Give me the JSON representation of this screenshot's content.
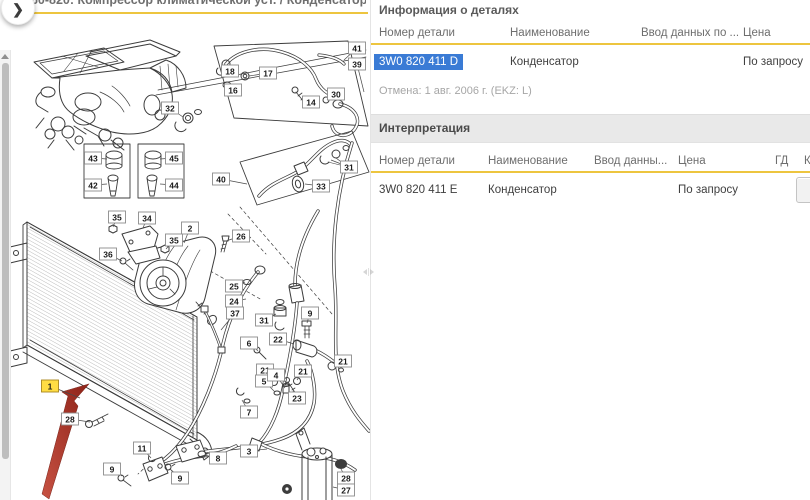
{
  "colors": {
    "accent_yellow": "#edc53f",
    "selection_blue": "#3a7bd5",
    "band_gray": "#e9e9e9",
    "highlight_yellow": "#ffdd44",
    "arrow_red": "#b13a2c"
  },
  "left_panel": {
    "title": "260-820: Компрессор климатической уст. / Конденсатор климат.уст...",
    "collapse_button": "❯",
    "diagram": {
      "highlighted_callout": "1",
      "callouts": [
        {
          "n": "32",
          "x": 170,
          "y": 108,
          "lx": 183,
          "ly": 117
        },
        {
          "n": "43",
          "x": 93,
          "y": 158,
          "lx": 107,
          "ly": 159
        },
        {
          "n": "42",
          "x": 93,
          "y": 185,
          "lx": 107,
          "ly": 184
        },
        {
          "n": "45",
          "x": 174,
          "y": 158,
          "lx": 160,
          "ly": 159
        },
        {
          "n": "44",
          "x": 174,
          "y": 185,
          "lx": 160,
          "ly": 184
        },
        {
          "n": "41",
          "x": 357,
          "y": 48,
          "lx": 344,
          "ly": 60
        },
        {
          "n": "39",
          "x": 357,
          "y": 64,
          "lx": 364,
          "ly": 92
        },
        {
          "n": "18",
          "x": 230,
          "y": 71,
          "lx": 222,
          "ly": 70
        },
        {
          "n": "16",
          "x": 233,
          "y": 90,
          "lx": 227,
          "ly": 84
        },
        {
          "n": "17",
          "x": 268,
          "y": 73,
          "lx": 249,
          "ly": 76
        },
        {
          "n": "14",
          "x": 311,
          "y": 102,
          "lx": 303,
          "ly": 99
        },
        {
          "n": "30",
          "x": 336,
          "y": 94,
          "lx": 327,
          "ly": 100
        },
        {
          "n": "31",
          "x": 349,
          "y": 167,
          "lx": 331,
          "ly": 160
        },
        {
          "n": "40",
          "x": 221,
          "y": 179,
          "lx": 247,
          "ly": 184
        },
        {
          "n": "33",
          "x": 321,
          "y": 186,
          "lx": 305,
          "ly": 184
        },
        {
          "n": "26",
          "x": 241,
          "y": 236,
          "lx": 226,
          "ly": 241
        },
        {
          "n": "2",
          "x": 190,
          "y": 228,
          "lx": 184,
          "ly": 243
        },
        {
          "n": "34",
          "x": 147,
          "y": 218,
          "lx": 143,
          "ly": 228
        },
        {
          "n": "35",
          "x": 117,
          "y": 217,
          "lx": 113,
          "ly": 227
        },
        {
          "n": "35",
          "x": 174,
          "y": 240,
          "lx": 166,
          "ly": 249
        },
        {
          "n": "36",
          "x": 108,
          "y": 254,
          "lx": 122,
          "ly": 261
        },
        {
          "n": "25",
          "x": 234,
          "y": 286,
          "lx": 245,
          "ly": 282
        },
        {
          "n": "24",
          "x": 234,
          "y": 301,
          "lx": 246,
          "ly": 299
        },
        {
          "n": "37",
          "x": 235,
          "y": 313,
          "lx": 221,
          "ly": 330
        },
        {
          "n": "31",
          "x": 264,
          "y": 320,
          "lx": 276,
          "ly": 314
        },
        {
          "n": "9",
          "x": 310,
          "y": 313,
          "lx": 307,
          "ly": 323
        },
        {
          "n": "22",
          "x": 278,
          "y": 339,
          "lx": 294,
          "ly": 344
        },
        {
          "n": "6",
          "x": 249,
          "y": 343,
          "lx": 258,
          "ly": 351
        },
        {
          "n": "21",
          "x": 265,
          "y": 370,
          "lx": 273,
          "ly": 380
        },
        {
          "n": "5",
          "x": 264,
          "y": 381,
          "lx": 275,
          "ly": 392
        },
        {
          "n": "4",
          "x": 276,
          "y": 375,
          "lx": 285,
          "ly": 388
        },
        {
          "n": "21",
          "x": 303,
          "y": 371,
          "lx": 297,
          "ly": 380
        },
        {
          "n": "23",
          "x": 297,
          "y": 398,
          "lx": 293,
          "ly": 391
        },
        {
          "n": "7",
          "x": 249,
          "y": 412,
          "lx": 242,
          "ly": 400
        },
        {
          "n": "1",
          "x": 50,
          "y": 386,
          "lx": 80,
          "ly": 398,
          "hl": true
        },
        {
          "n": "28",
          "x": 70,
          "y": 419,
          "lx": 90,
          "ly": 422
        },
        {
          "n": "11",
          "x": 142,
          "y": 448,
          "lx": 151,
          "ly": 458
        },
        {
          "n": "9",
          "x": 112,
          "y": 469,
          "lx": 122,
          "ly": 476
        },
        {
          "n": "9",
          "x": 180,
          "y": 478,
          "lx": 171,
          "ly": 470
        },
        {
          "n": "8",
          "x": 218,
          "y": 458,
          "lx": 204,
          "ly": 455
        },
        {
          "n": "3",
          "x": 249,
          "y": 451,
          "lx": 267,
          "ly": 449
        },
        {
          "n": "21",
          "x": 343,
          "y": 361,
          "lx": 334,
          "ly": 366
        },
        {
          "n": "28",
          "x": 346,
          "y": 478,
          "lx": 341,
          "ly": 469
        },
        {
          "n": "27",
          "x": 346,
          "y": 490,
          "lx": 333,
          "ly": 487
        }
      ]
    }
  },
  "right_panel": {
    "info": {
      "title": "Информация о деталях",
      "columns": [
        "Номер детали",
        "Наименование",
        "Ввод данных по ...",
        "Цена"
      ],
      "row": {
        "part_number": "3W0 820 411 D",
        "name": "Конденсатор",
        "data_entry": "",
        "price": "По запросу"
      },
      "note": "Отмена: 1 авг. 2006 г. (EKZ: L)"
    },
    "interpretation": {
      "title": "Интерпретация",
      "columns": [
        "Номер детали",
        "Наименование",
        "Ввод данны...",
        "Цена",
        "ГД",
        "К"
      ],
      "row": {
        "part_number": "3W0 820 411 E",
        "name": "Конденсатор",
        "data_entry": "",
        "price": "По запросу",
        "gd": ""
      }
    }
  }
}
